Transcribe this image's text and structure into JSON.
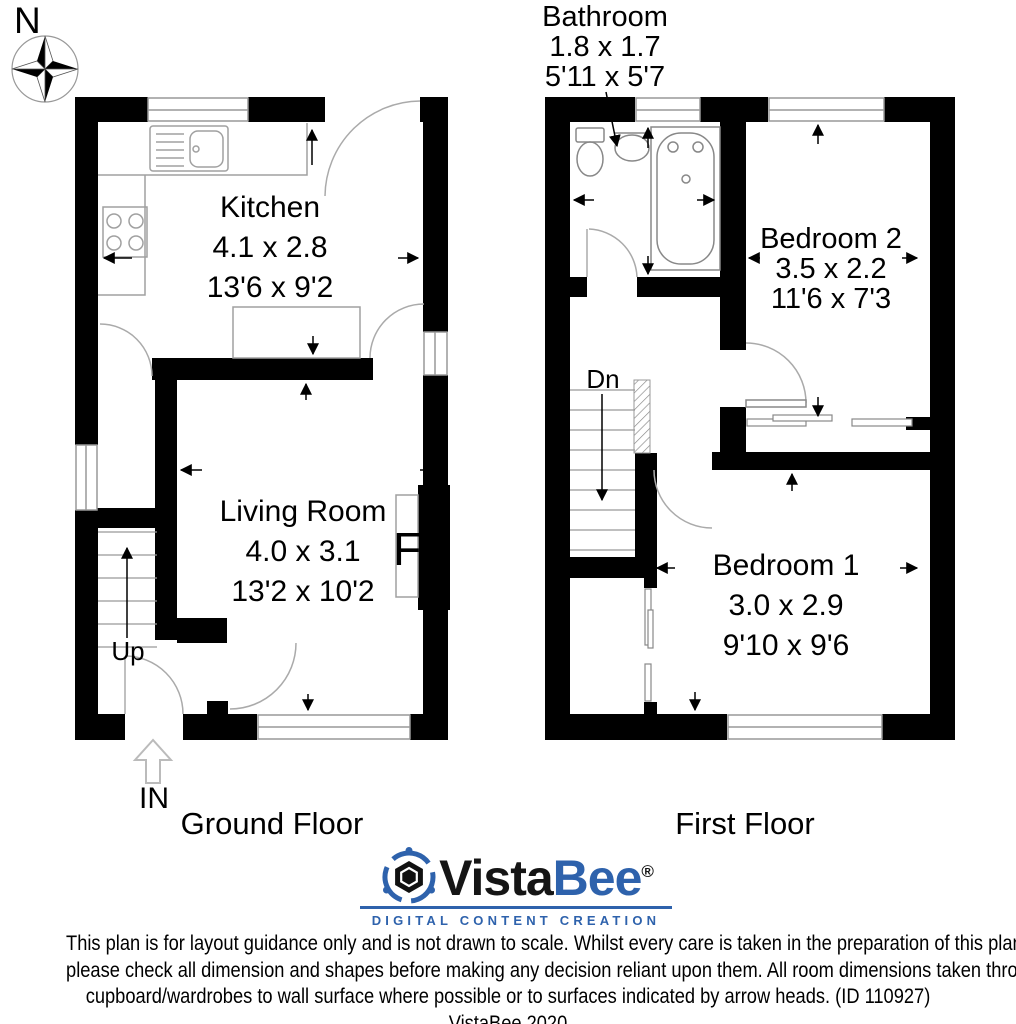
{
  "compass": {
    "label": "N"
  },
  "ground_floor": {
    "title": "Ground Floor",
    "rooms": {
      "kitchen": {
        "name": "Kitchen",
        "metric": "4.1 x 2.8",
        "imperial": "13'6 x 9'2"
      },
      "living_room": {
        "name": "Living Room",
        "metric": "4.0 x 3.1",
        "imperial": "13'2 x 10'2"
      }
    },
    "stairs_label": "Up",
    "entrance_label": "IN",
    "fireplace_label": "F"
  },
  "first_floor": {
    "title": "First Floor",
    "rooms": {
      "bathroom": {
        "name": "Bathroom",
        "metric": "1.8 x 1.7",
        "imperial": "5'11 x 5'7"
      },
      "bedroom2": {
        "name": "Bedroom 2",
        "metric": "3.5 x 2.2",
        "imperial": "11'6 x 7'3"
      },
      "bedroom1": {
        "name": "Bedroom 1",
        "metric": "3.0 x 2.9",
        "imperial": "9'10 x 9'6"
      }
    },
    "stairs_label": "Dn"
  },
  "branding": {
    "logo_vista": "Vista",
    "logo_bee": "Bee",
    "registered": "®",
    "tagline": "DIGITAL CONTENT CREATION",
    "brand_blue": "#2e62ac"
  },
  "disclaimer": {
    "lines": [
      "This plan is for layout guidance only and is not drawn to scale. Whilst every care is taken in the preparation of this plan,",
      "please check all dimension and shapes before making any decision reliant upon them. All room dimensions taken through",
      "cupboard/wardrobes to wall surface where possible or to surfaces indicated by arrow heads. (ID 110927)"
    ],
    "copyright": "VistaBee 2020"
  }
}
